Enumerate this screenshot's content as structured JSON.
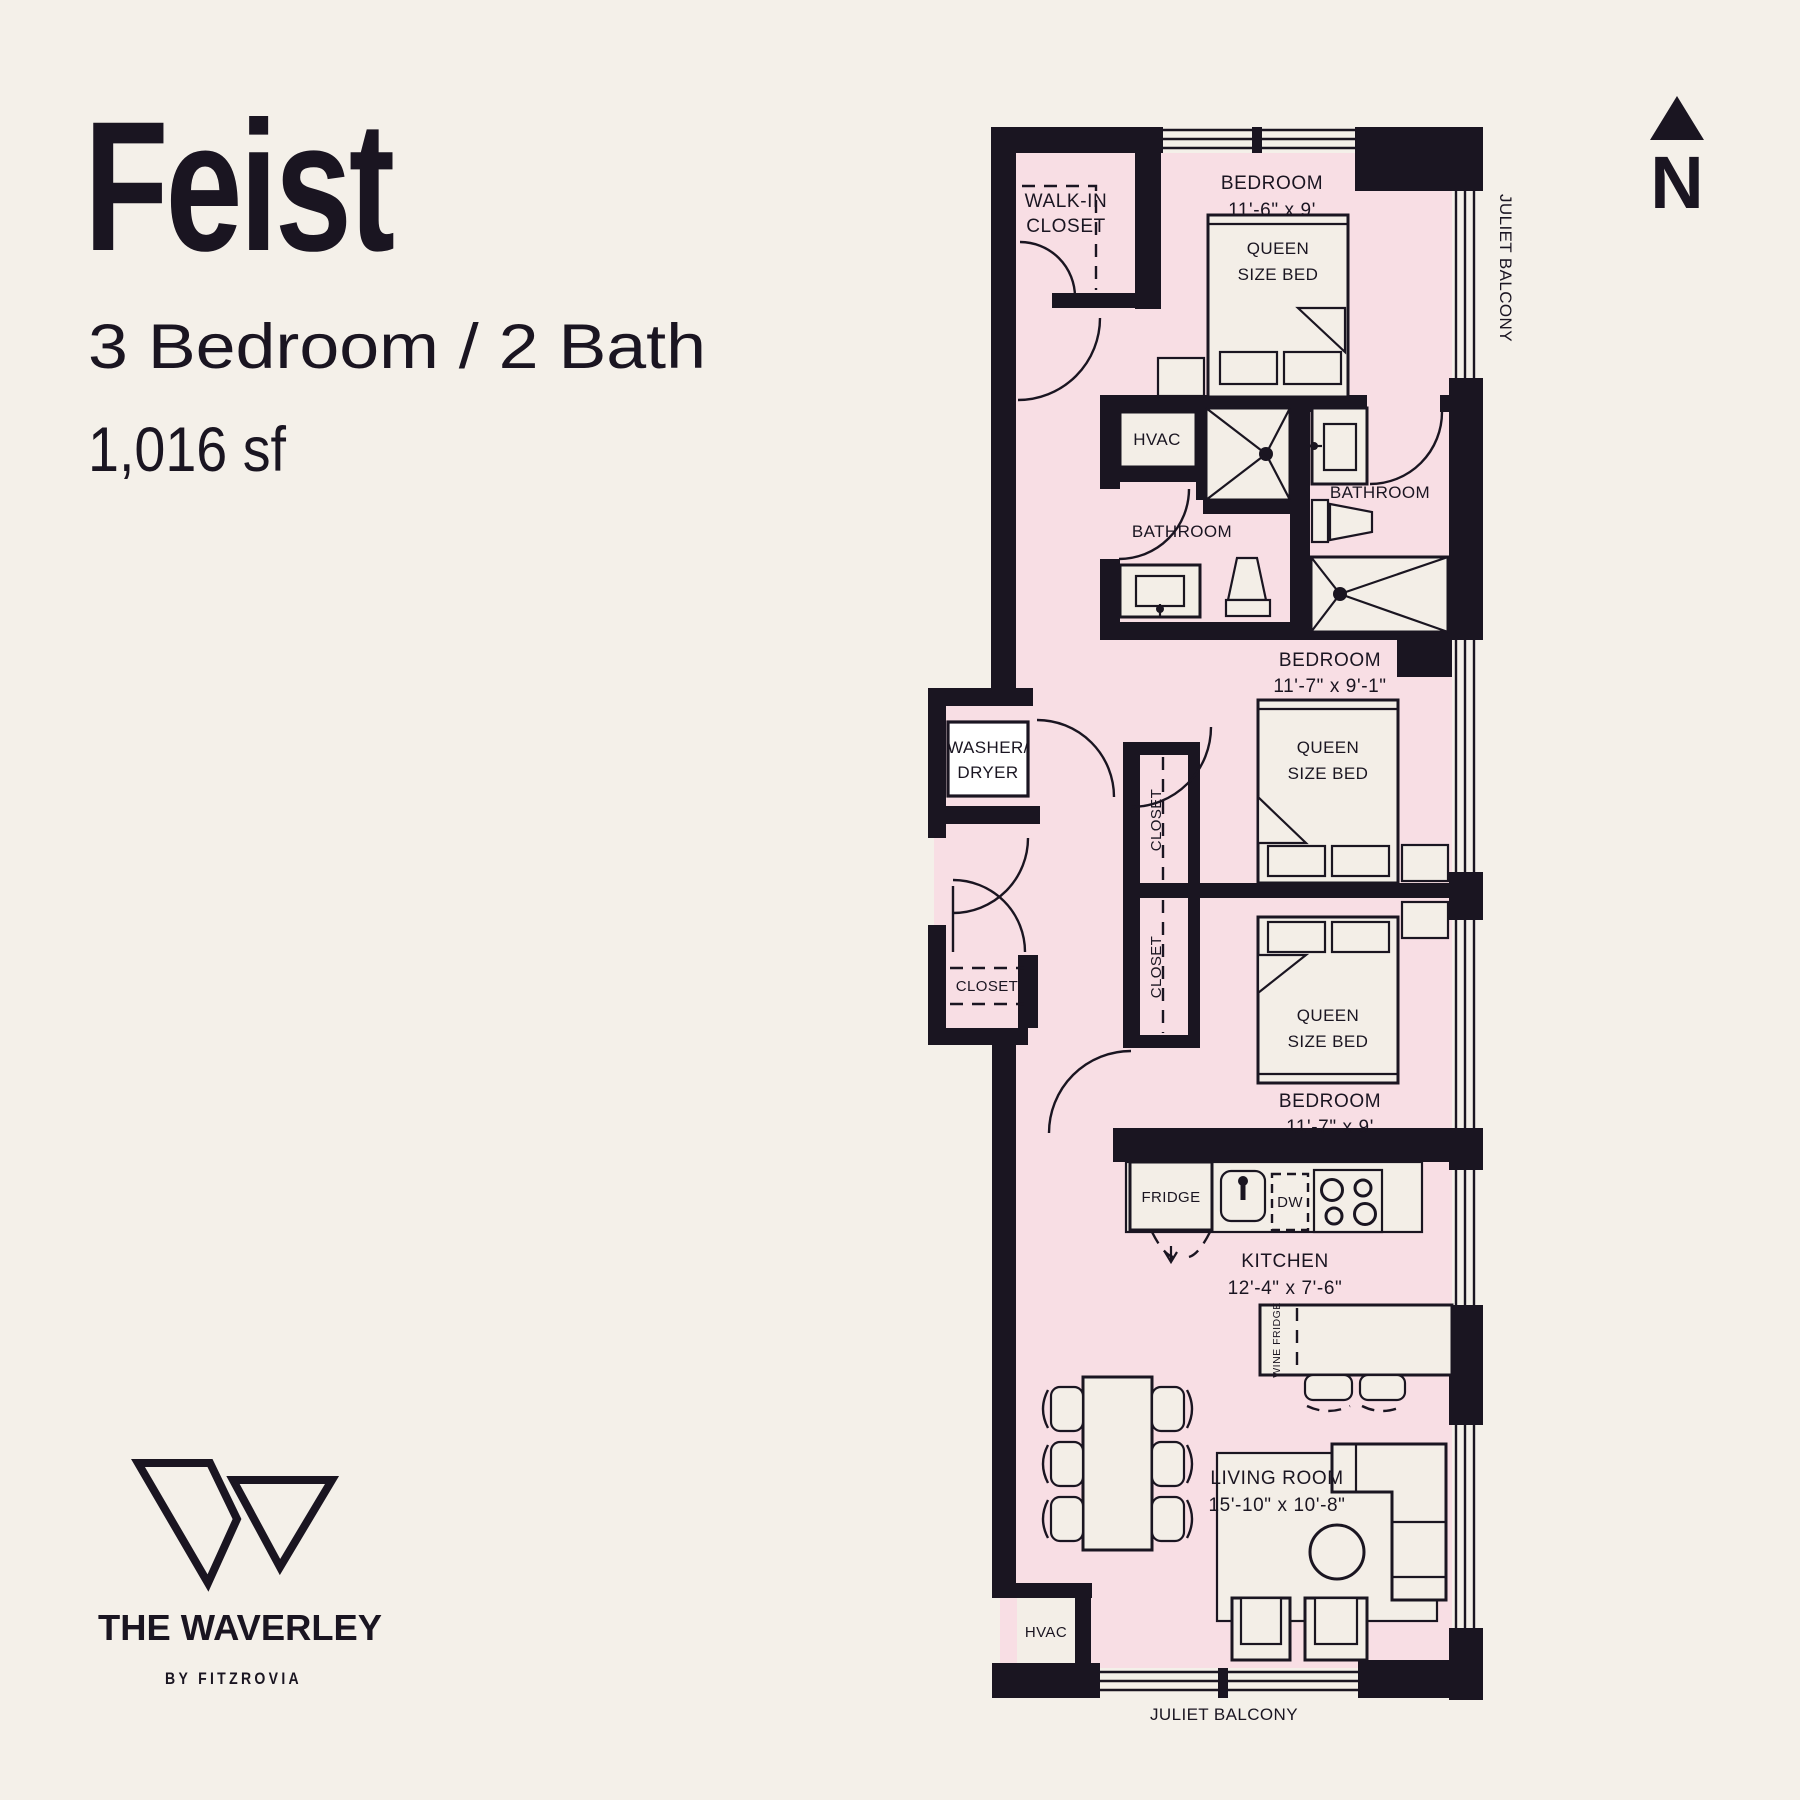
{
  "page": {
    "bg": "#f4f0e9",
    "ink": "#1a1521",
    "room_fill": "#f8dee4",
    "fixture_fill": "#f3eee7"
  },
  "header": {
    "title": "Feist",
    "subtitle": "3 Bedroom / 2 Bath",
    "area": "1,016 sf"
  },
  "compass": {
    "label": "N"
  },
  "brand": {
    "name": "THE WAVERLEY",
    "byline": "BY FITZROVIA"
  },
  "plan": {
    "juliet_right": "JULIET BALCONY",
    "juliet_bottom": "JULIET BALCONY",
    "walk_in_closet": {
      "line1": "WALK-IN",
      "line2": "CLOSET"
    },
    "bedroom1": {
      "label": "BEDROOM",
      "dims": "11'-6\" x 9'",
      "bed_line1": "QUEEN",
      "bed_line2": "SIZE BED"
    },
    "bedroom2": {
      "label": "BEDROOM",
      "dims": "11'-7\" x 9'-1\"",
      "bed_line1": "QUEEN",
      "bed_line2": "SIZE BED"
    },
    "bedroom3": {
      "label": "BEDROOM",
      "dims": "11'-7\" x 9'",
      "bed_line1": "QUEEN",
      "bed_line2": "SIZE BED"
    },
    "bathroom1": "BATHROOM",
    "bathroom2": "BATHROOM",
    "hvac_top": "HVAC",
    "hvac_bottom": "HVAC",
    "washer_dryer": {
      "line1": "WASHER/",
      "line2": "DRYER"
    },
    "closet_entry": "CLOSET",
    "closet_a": "CLOSET",
    "closet_b": "CLOSET",
    "kitchen": {
      "label": "KITCHEN",
      "dims": "12'-4\" x 7'-6\""
    },
    "fridge": "FRIDGE",
    "dw": "DW",
    "wine_fridge": "WINE FRIDGE",
    "living": {
      "label": "LIVING ROOM",
      "dims": "15'-10\" x 10'-8\""
    }
  }
}
